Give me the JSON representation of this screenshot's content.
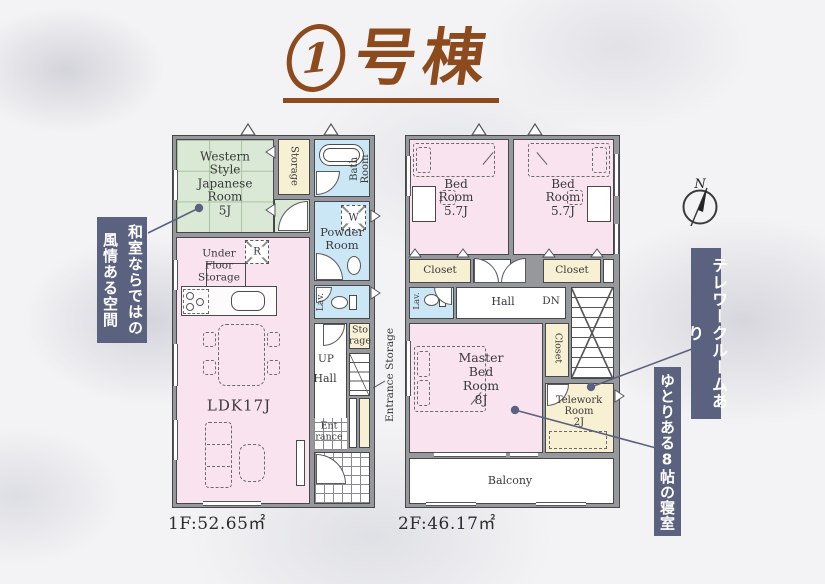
{
  "title": {
    "number": "1",
    "suffix": "号棟"
  },
  "compass_label": "N",
  "floor1": {
    "area_label": "1F:52.65㎡",
    "japanese_room": "Western\nStyle\nJapanese\nRoom\n5J",
    "storage_top": "Storage",
    "bath_room": "Bath\nRoom",
    "washer": "W",
    "powder_room": "Powder\nRoom",
    "lavatory": "Lav.",
    "fridge": "R",
    "under_floor_storage": "Under\nFloor\nStorage",
    "ldk": "LDK17J",
    "storage_mid": "Sto\nrage",
    "up": "UP",
    "hall": "Hall",
    "entrance": "Ent\nrance",
    "entrance_storage": "Entrance Storage"
  },
  "floor2": {
    "area_label": "2F:46.17㎡",
    "bedroom1": "Bed\nRoom\n5.7J",
    "bedroom2": "Bed\nRoom\n5.7J",
    "closet1": "Closet",
    "closet2": "Closet",
    "lavatory": "Lav.",
    "hall": "Hall",
    "down": "DN",
    "master_bedroom": "Master\nBed\nRoom\n8J",
    "closet3": "Closet",
    "telework_room": "Telework\nRoom\n2J",
    "balcony": "Balcony"
  },
  "annotations": {
    "japanese_room_note": "和室ならではの風情ある空間",
    "telework_note": "テレワークルームあり",
    "master_note": "ゆとりある8帖の寝室"
  },
  "colors": {
    "title": "#8c4a1d",
    "banner": "#5a6280",
    "room_pink": "#f8e3ee",
    "room_green": "#d9e9d5",
    "room_blue": "#cbe6f4",
    "room_cream": "#f7f0d3",
    "wall": "#97989c",
    "leader": "#5a6280"
  }
}
